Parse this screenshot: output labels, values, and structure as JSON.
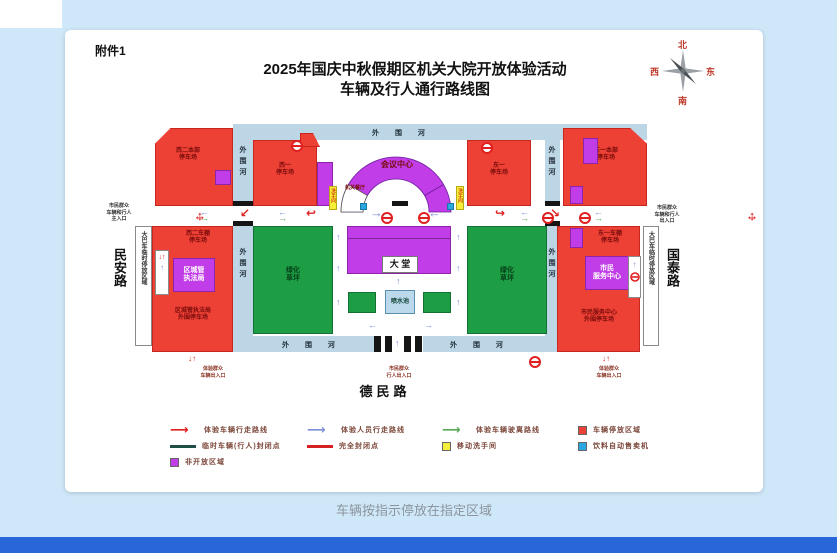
{
  "page": {
    "attachment": "附件1",
    "title1": "2025年国庆中秋假期区机关大院开放体验活动",
    "title2": "车辆及行人通行路线图",
    "caption": "车辆按指示停放在指定区域"
  },
  "compass": {
    "n": "北",
    "e": "东",
    "s": "南",
    "w": "西"
  },
  "roads": {
    "west": "民安路",
    "east": "国泰路",
    "south": "德民路"
  },
  "river": {
    "horizontal": "外 围 河",
    "vertical": "外围河"
  },
  "strips": {
    "bus": "大巴车临时停放区域"
  },
  "blocks": {
    "nw": {
      "l1": "西二本部",
      "l2": "停车场"
    },
    "w1": {
      "l1": "西一",
      "l2": "停车场"
    },
    "e1": {
      "l1": "东一",
      "l2": "停车场"
    },
    "ne": {
      "l1": "东一本部",
      "l2": "停车场"
    },
    "conference": "会议中心",
    "canteen": "机关餐厅",
    "lobby": "大 堂",
    "fountain": "喷水池",
    "lawn": {
      "l1": "绿化",
      "l2": "草坪"
    },
    "wshed": {
      "l1": "西二车棚",
      "l2": "停车场"
    },
    "csgj": {
      "l1": "区城管",
      "l2": "执法局"
    },
    "csgj_lot": {
      "l1": "区城管执法局",
      "l2": "外围停车场"
    },
    "eshed": {
      "l1": "东一车棚",
      "l2": "停车场"
    },
    "service": {
      "l1": "市民",
      "l2": "服务中心"
    },
    "service_lot": {
      "l1": "市民服务中心",
      "l2": "外围停车场"
    },
    "toilet": "洗手间"
  },
  "entrances": {
    "west": {
      "l1": "市民群众",
      "l2": "车辆和行人",
      "l3": "主入口"
    },
    "east": {
      "l1": "市民群众",
      "l2": "车辆和行人",
      "l3": "出入口"
    },
    "south": {
      "l1": "市民群众",
      "l2": "行人出入口"
    },
    "sw": {
      "l1": "体验群众",
      "l2": "车辆出入口"
    },
    "se": {
      "l1": "体验群众",
      "l2": "车辆出入口"
    }
  },
  "legend": {
    "items": [
      {
        "label": "体验车辆行走路线"
      },
      {
        "label": "体验人员行走路线"
      },
      {
        "label": "体验车辆驶离路线"
      },
      {
        "label": "车辆停放区域"
      },
      {
        "label": "临时车辆(行人)封闭点"
      },
      {
        "label": "完全封闭点"
      },
      {
        "label": "移动洗手间"
      },
      {
        "label": "饮料自动售卖机"
      },
      {
        "label": "非开放区域"
      }
    ]
  },
  "icons": {
    "h": "↔",
    "v": "↕",
    "up": "↑",
    "down": "↓",
    "left": "←",
    "right": "→",
    "uturn_left": "↩",
    "uturn_right": "↪",
    "diag_left": "↙",
    "diag_right": "↘",
    "legend_arrow": "⟶",
    "updown_red": "↓↑"
  },
  "colors": {
    "red_zone": "#ee4135",
    "purple_zone": "#c13de8",
    "green_zone": "#1d9e44",
    "river": "#bdd6e6",
    "yellow": "#f5ef3a",
    "cyan": "#2aa6e0",
    "route_red": "#e02020",
    "route_blue": "#7d8fd6",
    "route_green": "#58a858",
    "bottom_bar": "#2767d9"
  }
}
